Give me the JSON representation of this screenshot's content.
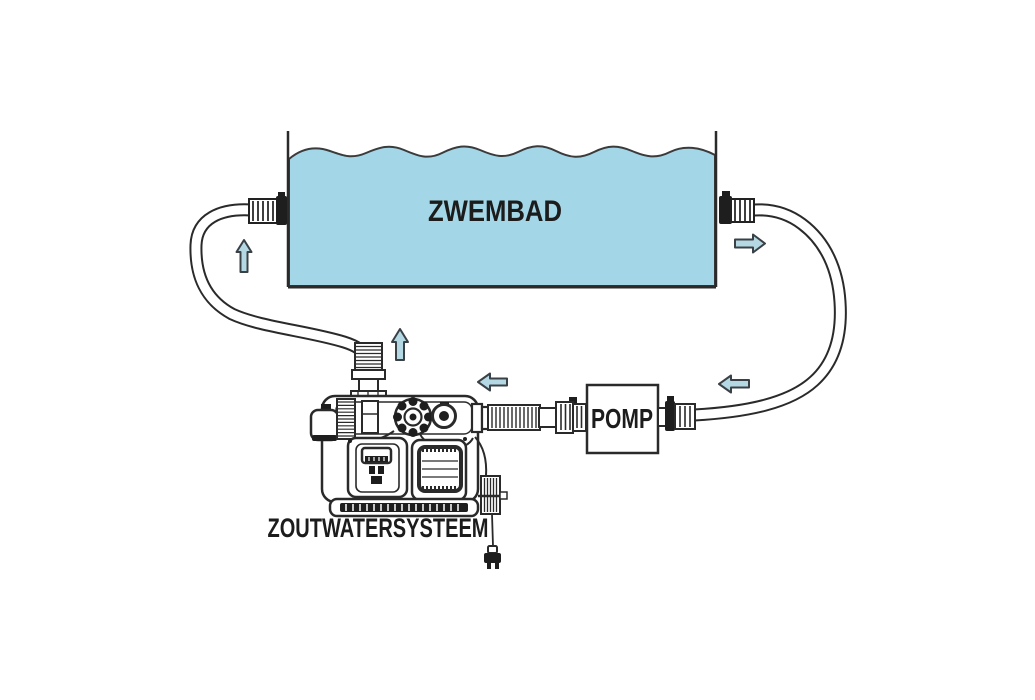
{
  "diagram": {
    "title": "Zoutwatersysteem zwembad aansluitschema",
    "labels": {
      "pool": "ZWEMBAD",
      "pump": "POMP",
      "saltwater_system": "ZOUTWATERSYSTEEM"
    },
    "colors": {
      "water": "#a3d7e8",
      "arrow_fill": "#b5d9e4",
      "arrow_stroke": "#3a4146",
      "line": "#2a2a2a",
      "background": "#ffffff"
    },
    "components": [
      {
        "name": "pool",
        "label": "ZWEMBAD"
      },
      {
        "name": "pump",
        "label": "POMP"
      },
      {
        "name": "saltwater-system",
        "label": "ZOUTWATERSYSTEEM"
      },
      {
        "name": "return-hose-left",
        "label": ""
      },
      {
        "name": "suction-hose-right",
        "label": ""
      },
      {
        "name": "power-plug",
        "label": ""
      }
    ],
    "flow_arrows": [
      {
        "id": "left-riser",
        "direction": "up"
      },
      {
        "id": "above-system",
        "direction": "up"
      },
      {
        "id": "system-inlet",
        "direction": "left"
      },
      {
        "id": "pool-outlet",
        "direction": "right"
      },
      {
        "id": "pump-inlet",
        "direction": "left"
      }
    ]
  }
}
